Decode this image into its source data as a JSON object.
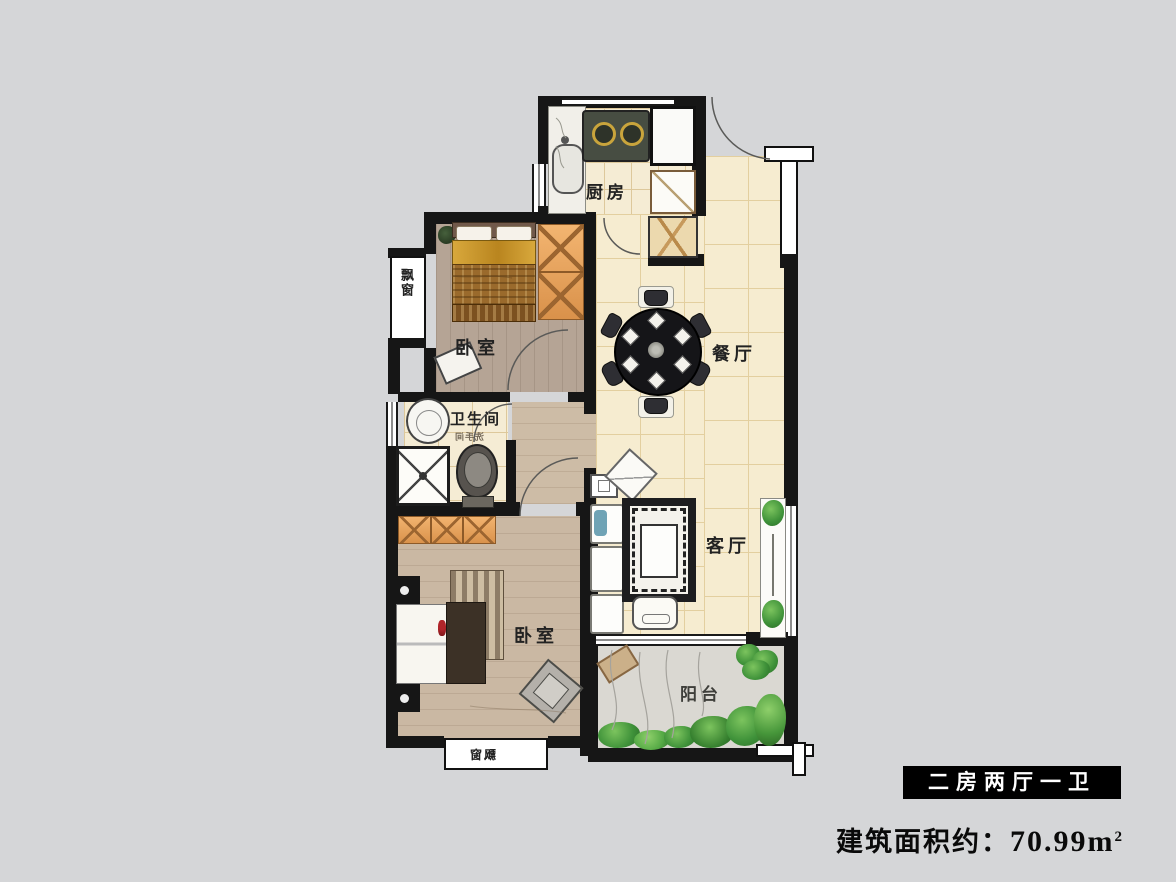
{
  "page": {
    "background": "#d5d6d8"
  },
  "plan": {
    "rooms": {
      "kitchen": {
        "label": "厨房"
      },
      "bedroom_top": {
        "label": "卧室"
      },
      "dining": {
        "label": "餐厅"
      },
      "bathroom": {
        "label": "卫生间",
        "sublabel": "洗手间"
      },
      "living": {
        "label": "客厅"
      },
      "bedroom_bottom": {
        "label": "卧室"
      },
      "balcony": {
        "label": "阳台"
      },
      "bay_window_left": {
        "label": "飘窗"
      },
      "bay_window_bottom": {
        "label": "飘窗"
      }
    }
  },
  "legend": {
    "type_badge": "二房两厅一卫",
    "area_prefix": "建筑面积约：",
    "area_value": "70.99",
    "area_unit": "m",
    "area_exponent": "2"
  },
  "colors": {
    "wall": "#161616",
    "tile_floor": "#f6ecd0",
    "wood_floor": "#cab8a3",
    "wardrobe": "#e9a55e",
    "plant_green": "#3e9139",
    "badge_bg": "#000000",
    "badge_text": "#ffffff"
  }
}
